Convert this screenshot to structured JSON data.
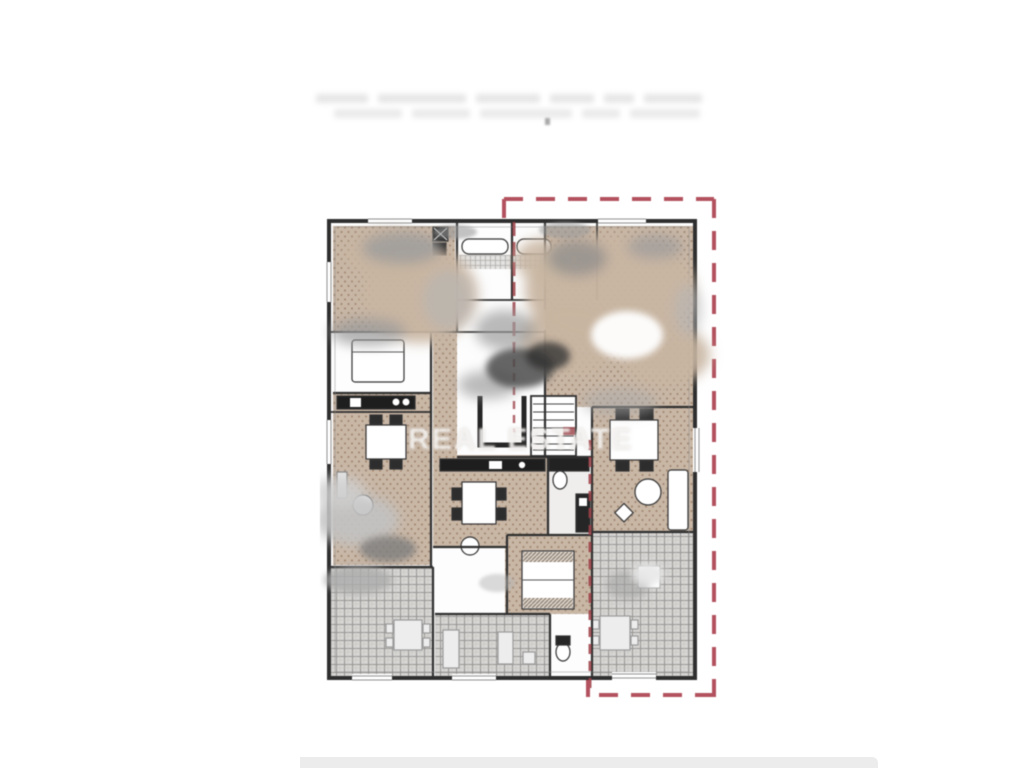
{
  "page": {
    "background_color": "#ffffff",
    "footer_bar_color": "#ececec"
  },
  "header": {
    "caption_legible": false,
    "caption_line_count": 2
  },
  "floorplan": {
    "watermark": "REAL ESTATE",
    "unit_boundary_color": "#b3525e",
    "unit_inner_line_color": "#9c4148",
    "wall_color": "#2f2f2f",
    "floor_color": "#c9b7a6",
    "floor_dot_color": "#a38b75",
    "terrace_tile_color": "#d7d6d4",
    "terrace_grid_color": "#979592"
  }
}
